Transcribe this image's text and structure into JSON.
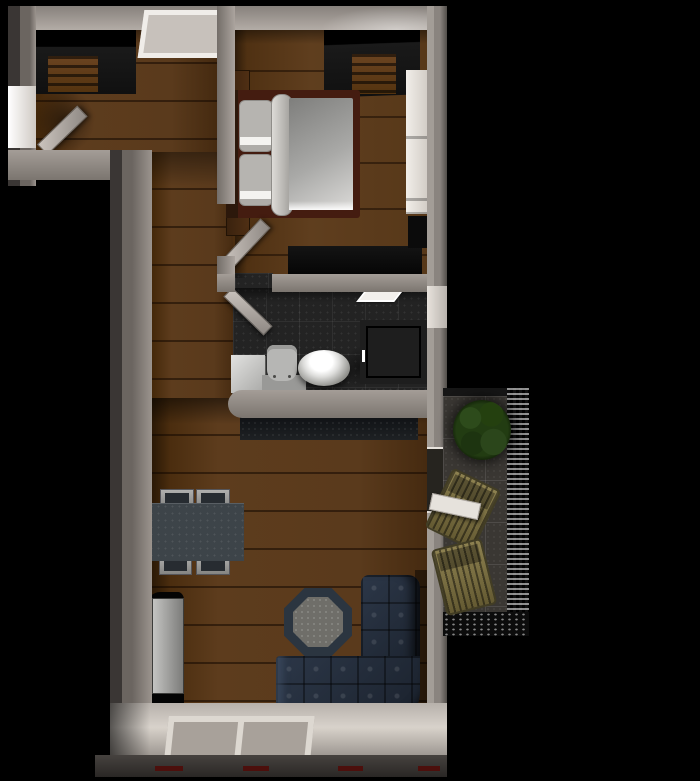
{
  "scene": {
    "type": "3d-floorplan-top-view",
    "rooms": [
      {
        "name": "small-room",
        "furniture": [
          "wardrobe-open",
          "door-open",
          "window-left",
          "window-top"
        ]
      },
      {
        "name": "bedroom",
        "furniture": [
          "double-bed",
          "nightstand-upper",
          "nightstand-lower",
          "wardrobe-open",
          "white-closet",
          "low-dresser",
          "door-open"
        ]
      },
      {
        "name": "bathroom",
        "furniture": [
          "sink-cabinet",
          "toilet",
          "wash-bowl",
          "shower-cabin",
          "ceiling-light",
          "window-right",
          "door-open"
        ]
      },
      {
        "name": "living-room",
        "furniture": [
          "dining-table",
          "chair",
          "chair",
          "chair",
          "chair",
          "kitchen-counter",
          "tv-unit",
          "octagon-coffee-table",
          "corner-sofa",
          "balcony-door-open"
        ]
      },
      {
        "name": "balcony",
        "furniture": [
          "plant-bush",
          "patio-chair",
          "patio-chair",
          "railing"
        ]
      },
      {
        "name": "entry",
        "furniture": [
          "floor-window-two-pane"
        ]
      }
    ],
    "dining_chair_count": 4,
    "patio_chair_count": 2
  },
  "colors": {
    "bg": "#000000",
    "wall": "#8f8984",
    "wall_light": "#b3aca6",
    "wall_dark": "#4f4b47",
    "wood": "#5a3a1c",
    "bath_floor": "#232323",
    "balcony_floor": "#3a3733",
    "sofa": "#2c3748",
    "sofa_dark": "#1a212c",
    "table_top": "#3d4449",
    "octagon_rim": "#2b3540",
    "plant": "#223c12",
    "patio_chair": "#8d8150",
    "duvet": "#a9a9a7",
    "headboard": "#2c180b",
    "bed_frame": "#441c10",
    "white_closet": "#f1eee9",
    "red_dash": "#4c0f0c"
  }
}
